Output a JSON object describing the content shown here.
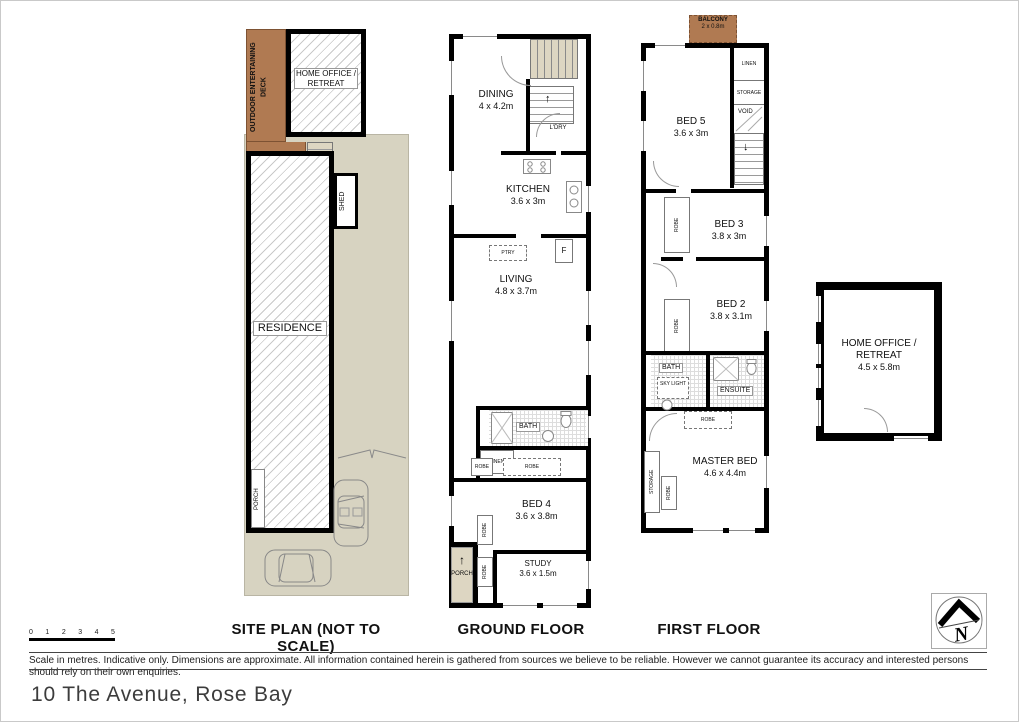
{
  "address": "10 The Avenue, Rose Bay",
  "disclaimer": "Scale in metres. Indicative only. Dimensions are approximate. All information contained herein is gathered from sources we believe to be reliable. However we cannot guarantee its accuracy and interested persons should rely on their own enquiries.",
  "north_label": "N",
  "icons": {
    "up_arrow": "↑",
    "down_arrow": "↓"
  },
  "scale_bar": {
    "t0": "0",
    "t1": "1",
    "t2": "2",
    "t3": "3",
    "t4": "4",
    "t5": "5"
  },
  "colors": {
    "lot": "#d7d3c1",
    "deck_brown": "#b07a52",
    "wall": "#000000"
  },
  "site_plan": {
    "caption": "SITE PLAN (NOT TO SCALE)",
    "deck_label": "OUTDOOR ENTERTAINING DECK",
    "home_office_label": "HOME OFFICE / RETREAT",
    "shed_label": "SHED",
    "residence_label": "RESIDENCE",
    "porch_label": "PORCH"
  },
  "ground_floor": {
    "caption": "GROUND FLOOR",
    "dining_name": "DINING",
    "dining_size": "4 x 4.2m",
    "ldry_label": "L'DRY",
    "kitchen_name": "KITCHEN",
    "kitchen_size": "3.6 x 3m",
    "ptry_label": "PTRY",
    "fridge_label": "F",
    "living_name": "LIVING",
    "living_size": "4.8 x 3.7m",
    "bath_label": "BATH",
    "linen_label": "LINEN",
    "robe_label_1": "ROBE",
    "robe_label_2": "ROBE",
    "bed4_name": "BED 4",
    "bed4_size": "3.6 x 3.8m",
    "robe_label_3": "ROBE",
    "robe_label_4": "ROBE",
    "study_name": "STUDY",
    "study_size": "3.6 x 1.5m",
    "porch_label": "PORCH"
  },
  "first_floor": {
    "caption": "FIRST FLOOR",
    "balcony_name": "BALCONY",
    "balcony_size": "2 x 0.8m",
    "linen_label": "LINEN",
    "storage_label_1": "STORAGE",
    "void_label": "VOID",
    "bed5_name": "BED 5",
    "bed5_size": "3.6 x 3m",
    "robe_label_1": "ROBE",
    "bed3_name": "BED 3",
    "bed3_size": "3.8 x 3m",
    "bed2_name": "BED 2",
    "bed2_size": "3.8 x 3.1m",
    "robe_label_2": "ROBE",
    "bath_label": "BATH",
    "skylight_label": "SKY LIGHT",
    "ensuite_label": "ENSUITE",
    "robe_label_3": "ROBE",
    "master_name": "MASTER BED",
    "master_size": "4.6 x 4.4m",
    "storage_label_2": "STORAGE",
    "robe_label_4": "ROBE"
  },
  "home_office": {
    "label": "HOME OFFICE / RETREAT",
    "size": "4.5 x 5.8m"
  }
}
